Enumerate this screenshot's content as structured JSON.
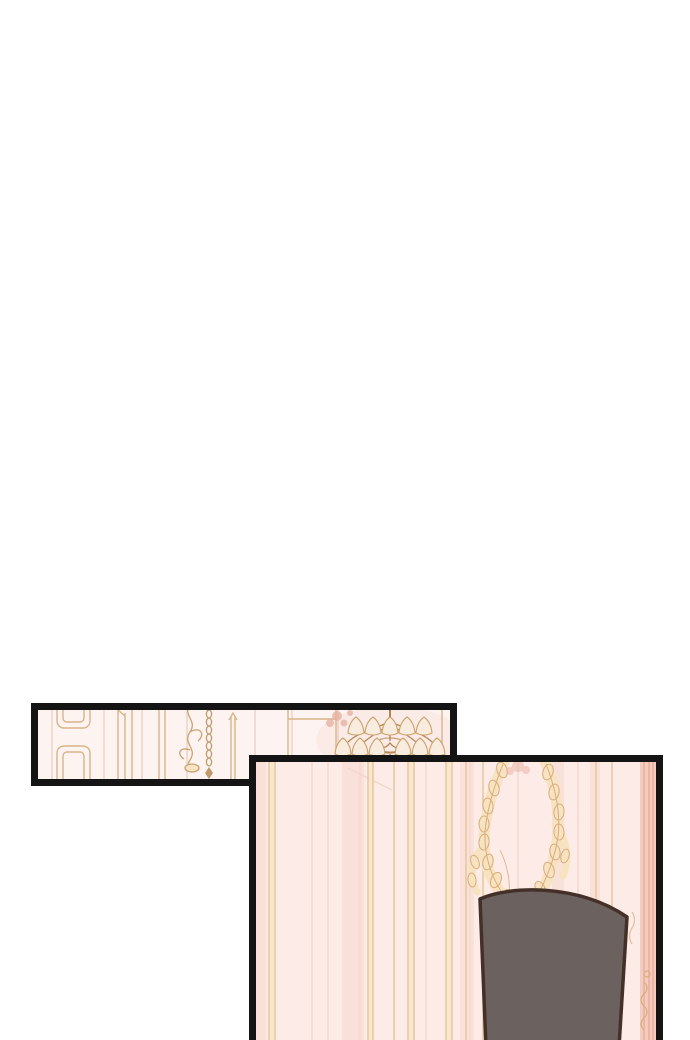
{
  "meta": {
    "kind": "webtoon-comic-page-segment",
    "panel_count": 2,
    "visible_text": ""
  },
  "colors": {
    "page_bg": "#ffffff",
    "panel_border": "#141414",
    "p1_wall": "#fdf4f1",
    "p1_line_faint": "#f2dcd2",
    "p1_line_gold": "#d9b489",
    "p1_scroll": "#caa272",
    "p1_chain": "#bf9a6b",
    "p1_shade_fill": "#f8ecdf",
    "p1_shade_stroke": "#cda26c",
    "p1_brass": "#b2854f",
    "rose_accent": "#e7b0a1",
    "p2_wall": "#fcebe7",
    "p2_stripe": "#f7d9cf",
    "p2_line_gold": "#e6c497",
    "p2_line_light": "#f8e7cd",
    "p2_line_faint": "#f3d6ca",
    "garland_fill": "#f7e3c0",
    "garland_stroke": "#d9ad7e",
    "chair_fill": "#6b6260",
    "chair_outline": "#453029",
    "rose_band": "#f2c9ba",
    "rose_streak": "#e8a892"
  },
  "panels": [
    {
      "id": "panel-top-wide",
      "scene": "ornate pale palace wall: panel moldings, hanging chain, gold chandelier at right"
    },
    {
      "id": "panel-bottom-large",
      "scene": "pale pink paneled wall with gilded garland ornament and dark gray chair back, cut off at page bottom"
    }
  ]
}
